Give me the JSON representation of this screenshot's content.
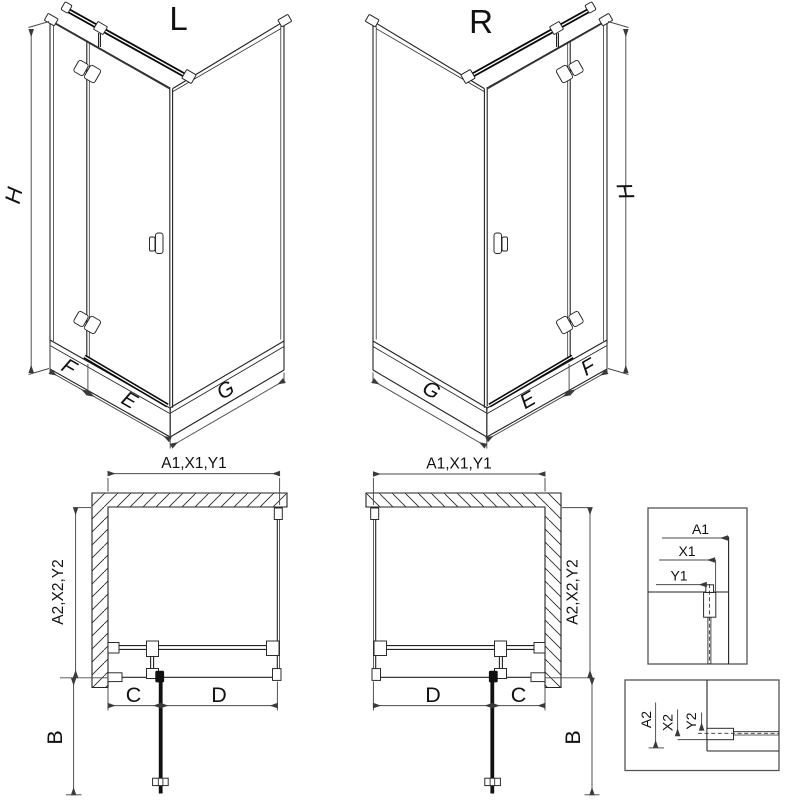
{
  "page": {
    "background": "#ffffff"
  },
  "units": {
    "left": {
      "title": "L",
      "height": "H",
      "side_width": "F",
      "door_width": "E",
      "panel_width": "G"
    },
    "right": {
      "title": "R",
      "height": "H",
      "side_width": "F",
      "door_width": "E",
      "panel_width": "G"
    }
  },
  "plans": {
    "left": {
      "width_dim": "A1,X1,Y1",
      "depth_dim": "A2,X2,Y2",
      "door_clearance": "B",
      "wall_segment": "C",
      "door_segment": "D"
    },
    "right": {
      "width_dim": "A1,X1,Y1",
      "depth_dim": "A2,X2,Y2",
      "door_clearance": "B",
      "wall_segment": "C",
      "door_segment": "D"
    }
  },
  "details": {
    "width_box": {
      "dims": [
        "A1",
        "X1",
        "Y1"
      ]
    },
    "depth_box": {
      "dims": [
        "A2",
        "X2",
        "Y2"
      ]
    }
  },
  "colors": {
    "line": "#222222",
    "dim": "#4a4a4a",
    "thick": "#0a0a0a",
    "box_border": "#555555"
  }
}
